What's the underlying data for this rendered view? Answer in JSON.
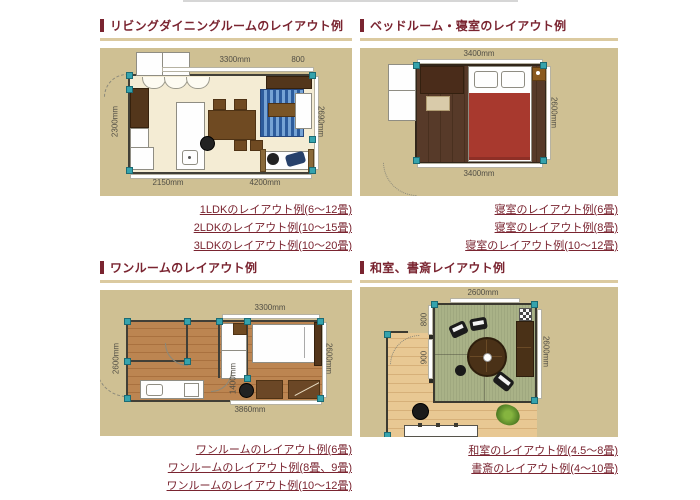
{
  "theme": {
    "accent": "#7a2430",
    "rule": "#dbcaa0",
    "card_bg": "#cfc093",
    "link_color": "#7a2430",
    "corner_marker": "#35a3ad",
    "dim_text": "#514e45"
  },
  "sections": [
    {
      "id": "living-dining",
      "title": "リビングダイニングルームのレイアウト例",
      "dims": {
        "top_main": "3300mm",
        "top_sub": "800",
        "left": "2300mm",
        "right": "2690mm",
        "bottom_left": "2150mm",
        "bottom_main": "4200mm"
      },
      "links": [
        "1LDKのレイアウト例(6〜12畳)",
        "2LDKのレイアウト例(10〜15畳)",
        "3LDKのレイアウト例(10〜20畳)"
      ]
    },
    {
      "id": "bedroom",
      "title": "ベッドルーム・寝室のレイアウト例",
      "dims": {
        "top": "3400mm",
        "right": "2600mm",
        "bottom": "3400mm"
      },
      "links": [
        "寝室のレイアウト例(6畳)",
        "寝室のレイアウト例(8畳)",
        "寝室のレイアウト例(10〜12畳)"
      ]
    },
    {
      "id": "one-room",
      "title": "ワンルームのレイアウト例",
      "dims": {
        "top": "3300mm",
        "left": "2600mm",
        "mid": "1400mm",
        "right": "2600mm",
        "bottom": "3860mm"
      },
      "links": [
        "ワンルームのレイアウト例(6畳)",
        "ワンルームのレイアウト例(8畳、9畳)",
        "ワンルームのレイアウト例(10〜12畳)"
      ]
    },
    {
      "id": "washitsu-study",
      "title": "和室、書斎レイアウト例",
      "dims": {
        "top": "2600mm",
        "right": "2600mm",
        "left_upper": "800",
        "left_lower": "900"
      },
      "links": [
        "和室のレイアウト例(4.5〜8畳)",
        "書斎のレイアウト例(4〜10畳)"
      ]
    }
  ]
}
